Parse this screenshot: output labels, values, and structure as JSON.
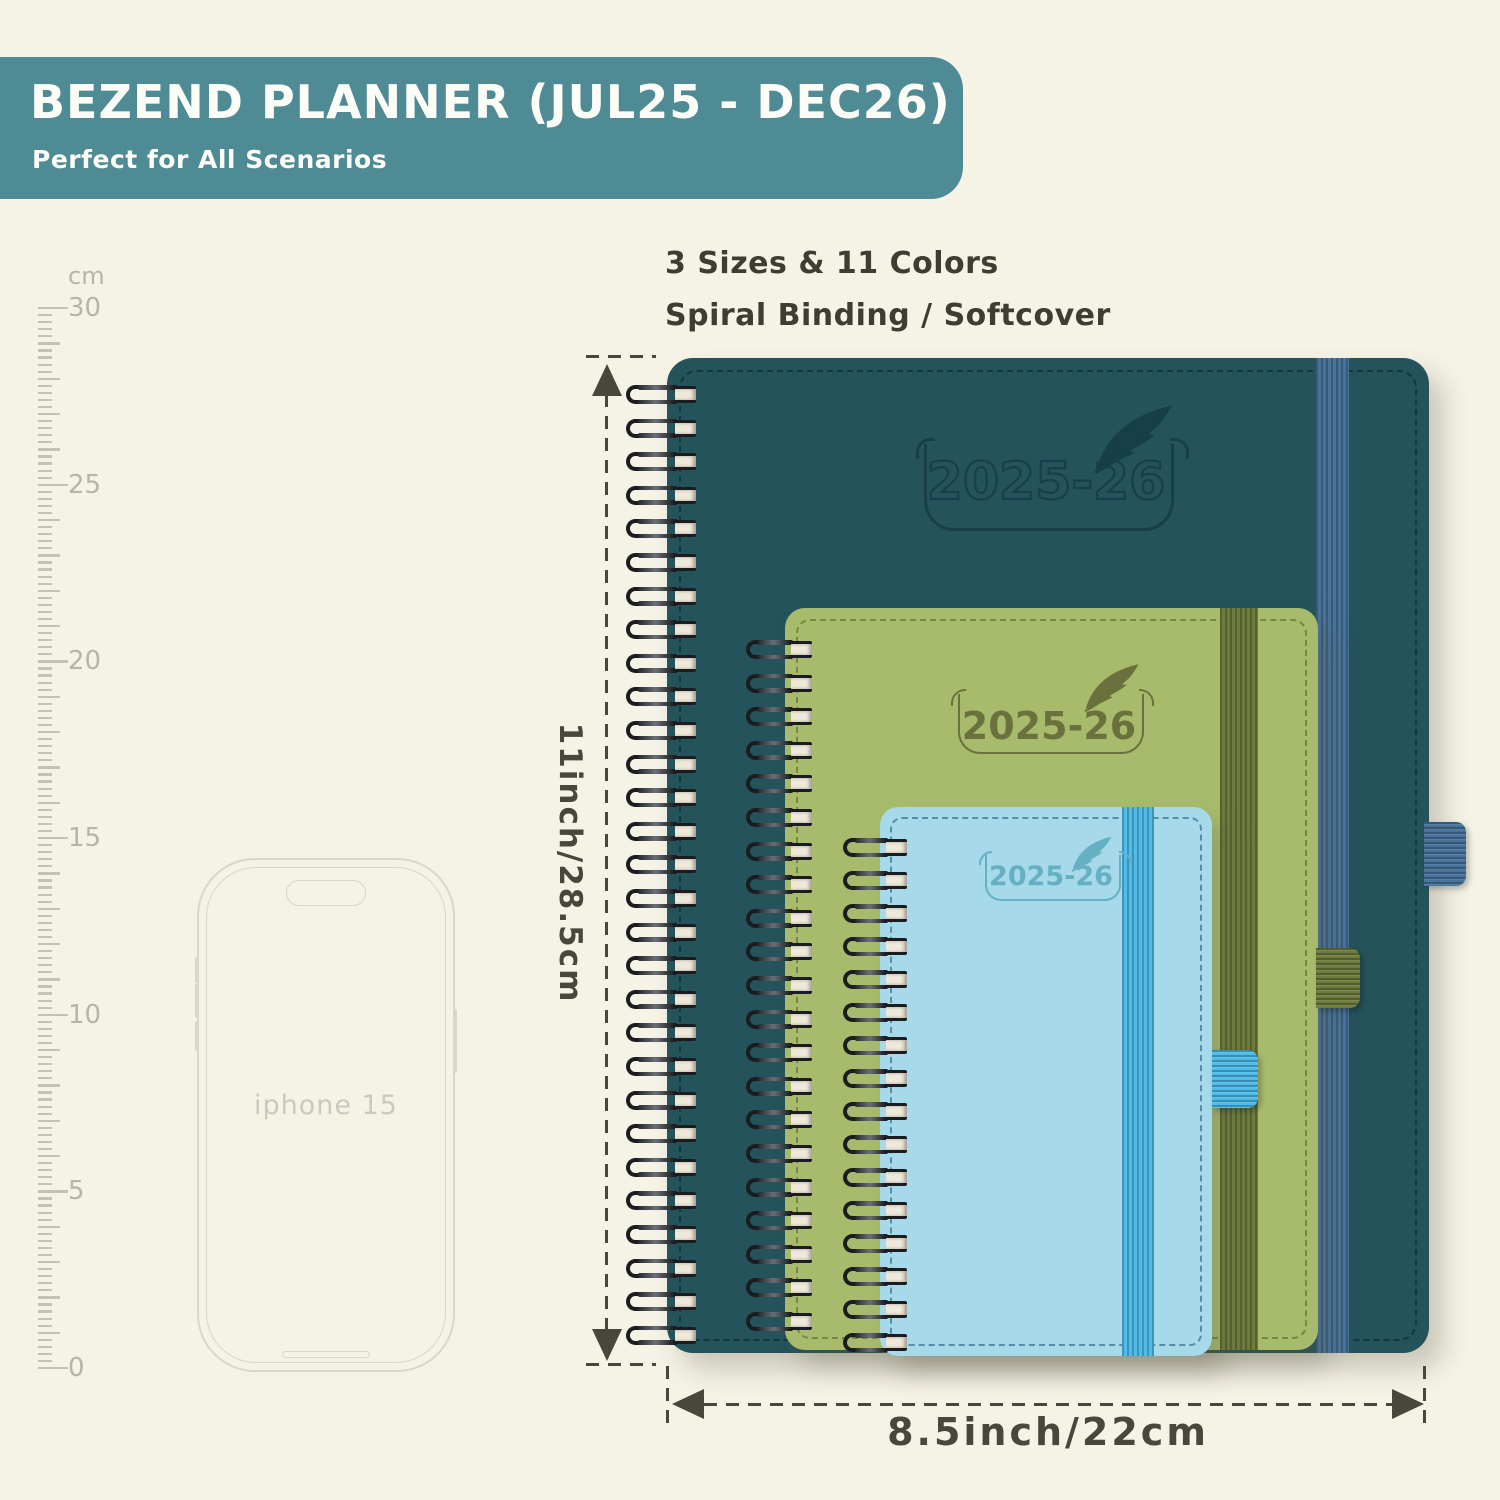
{
  "banner": {
    "title": "BEZEND PLANNER (JUL25 - DEC26)",
    "subtitle": "Perfect for All Scenarios"
  },
  "info": {
    "line1": "3 Sizes & 11 Colors",
    "line2": "Spiral Binding / Softcover"
  },
  "ruler": {
    "unit_label": "cm",
    "min": 0,
    "max": 30,
    "label_every": 5
  },
  "phone": {
    "label": "iphone 15"
  },
  "dimensions": {
    "height_label": "11inch/28.5cm",
    "width_label": "8.5inch/22cm"
  },
  "planners": [
    {
      "name": "large",
      "year_label": "2025-26"
    },
    {
      "name": "medium",
      "year_label": "2025-26"
    },
    {
      "name": "small",
      "year_label": "2025-26"
    }
  ],
  "colors": {
    "bg": "#f5f2e6",
    "banner_bg": "#4f8b95",
    "banner_text": "#fdfdf8",
    "text_dark": "#3f3c33",
    "dim": "#49463e",
    "ruler": "#c4c1b7",
    "ruler_text": "#b7b4a9",
    "phone_line": "#d9d6cb",
    "phone_text": "#cbc8bd",
    "cover_l": "#24535c",
    "band_l": "#48749c",
    "logo_l": "#173f49",
    "stitch_l": "rgba(5,38,45,0.6)",
    "cover_m": "#a8bb6d",
    "band_m": "#6f7c3e",
    "logo_m": "#6b713c",
    "stitch_m": "rgba(70,80,30,0.5)",
    "cover_s": "#a6d9ea",
    "band_s": "#4fbce9",
    "logo_s": "#66b0c4",
    "stitch_s": "rgba(23,80,112,0.55)"
  }
}
